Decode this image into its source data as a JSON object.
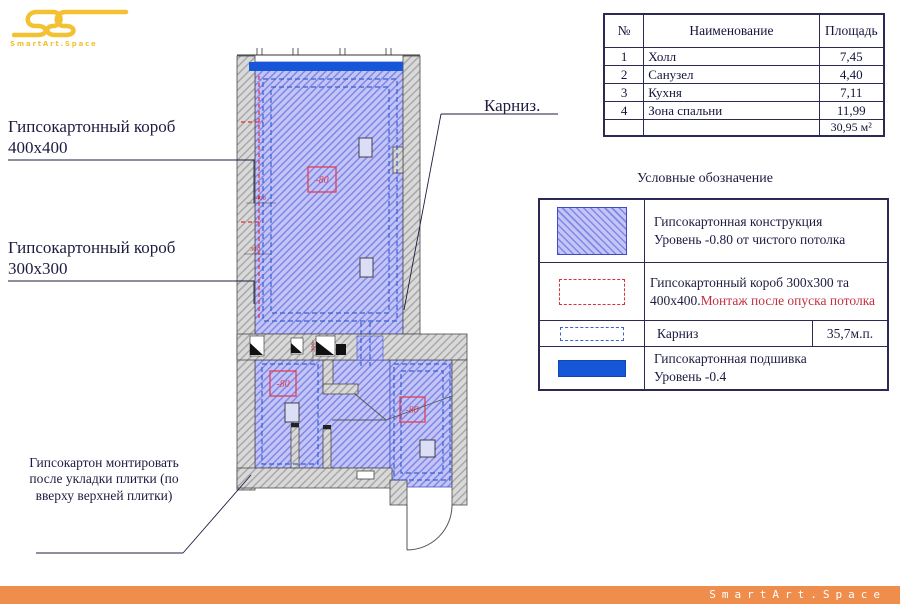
{
  "logo": {
    "subtitle": "SmartArt.Space"
  },
  "footer": {
    "brand": "SmartArt.Space"
  },
  "labels": {
    "korob400_l1": "Гипсокартонный короб",
    "korob400_l2": "400x400",
    "korob300_l1": "Гипсокартонный короб",
    "korob300_l2": "300x300",
    "karniz": "Карниз.",
    "tile_note": "Гипсокартон монтировать после укладки плитки (по вверху верхней плитки)"
  },
  "plan": {
    "level_mark_1": "-80",
    "level_mark_2": "-80",
    "level_mark_3": "-80",
    "dim_400": "400",
    "dim_300": "300",
    "dim_300_v": "300"
  },
  "rooms_table": {
    "headers": {
      "num": "№",
      "name": "Наименование",
      "area": "Площадь"
    },
    "rows": [
      {
        "num": "1",
        "name": "Холл",
        "area": "7,45"
      },
      {
        "num": "2",
        "name": "Санузел",
        "area": "4,40"
      },
      {
        "num": "3",
        "name": "Кухня",
        "area": "7,11"
      },
      {
        "num": "4",
        "name": "Зона спальни",
        "area": "11,99"
      }
    ],
    "total": "30,95 м²"
  },
  "legend": {
    "title": "Условные обозначение",
    "row1": {
      "l1": "Гипсокартонная конструкция",
      "l2": "Уровень -0.80 от чистого потолка"
    },
    "row2": {
      "dark": "Гипсокартонный короб 300x300 та 400x400.",
      "red": "Монтаж после опуска потолка"
    },
    "row3": {
      "label": "Карниз",
      "value": "35,7м.п."
    },
    "row4": {
      "l1": "Гипсокартонная подшивка",
      "l2": "Уровень -0.4"
    }
  },
  "colors": {
    "accent_gold": "#f2c233",
    "footer_orange": "#ef8d4d",
    "plan_blue_fill": "#c3c5f6",
    "plan_blue_line": "#8287e6",
    "solid_blue": "#1656d8",
    "cornice_blue": "#3a62d0",
    "red_dash": "#e03038",
    "ink": "#1c1c40"
  }
}
